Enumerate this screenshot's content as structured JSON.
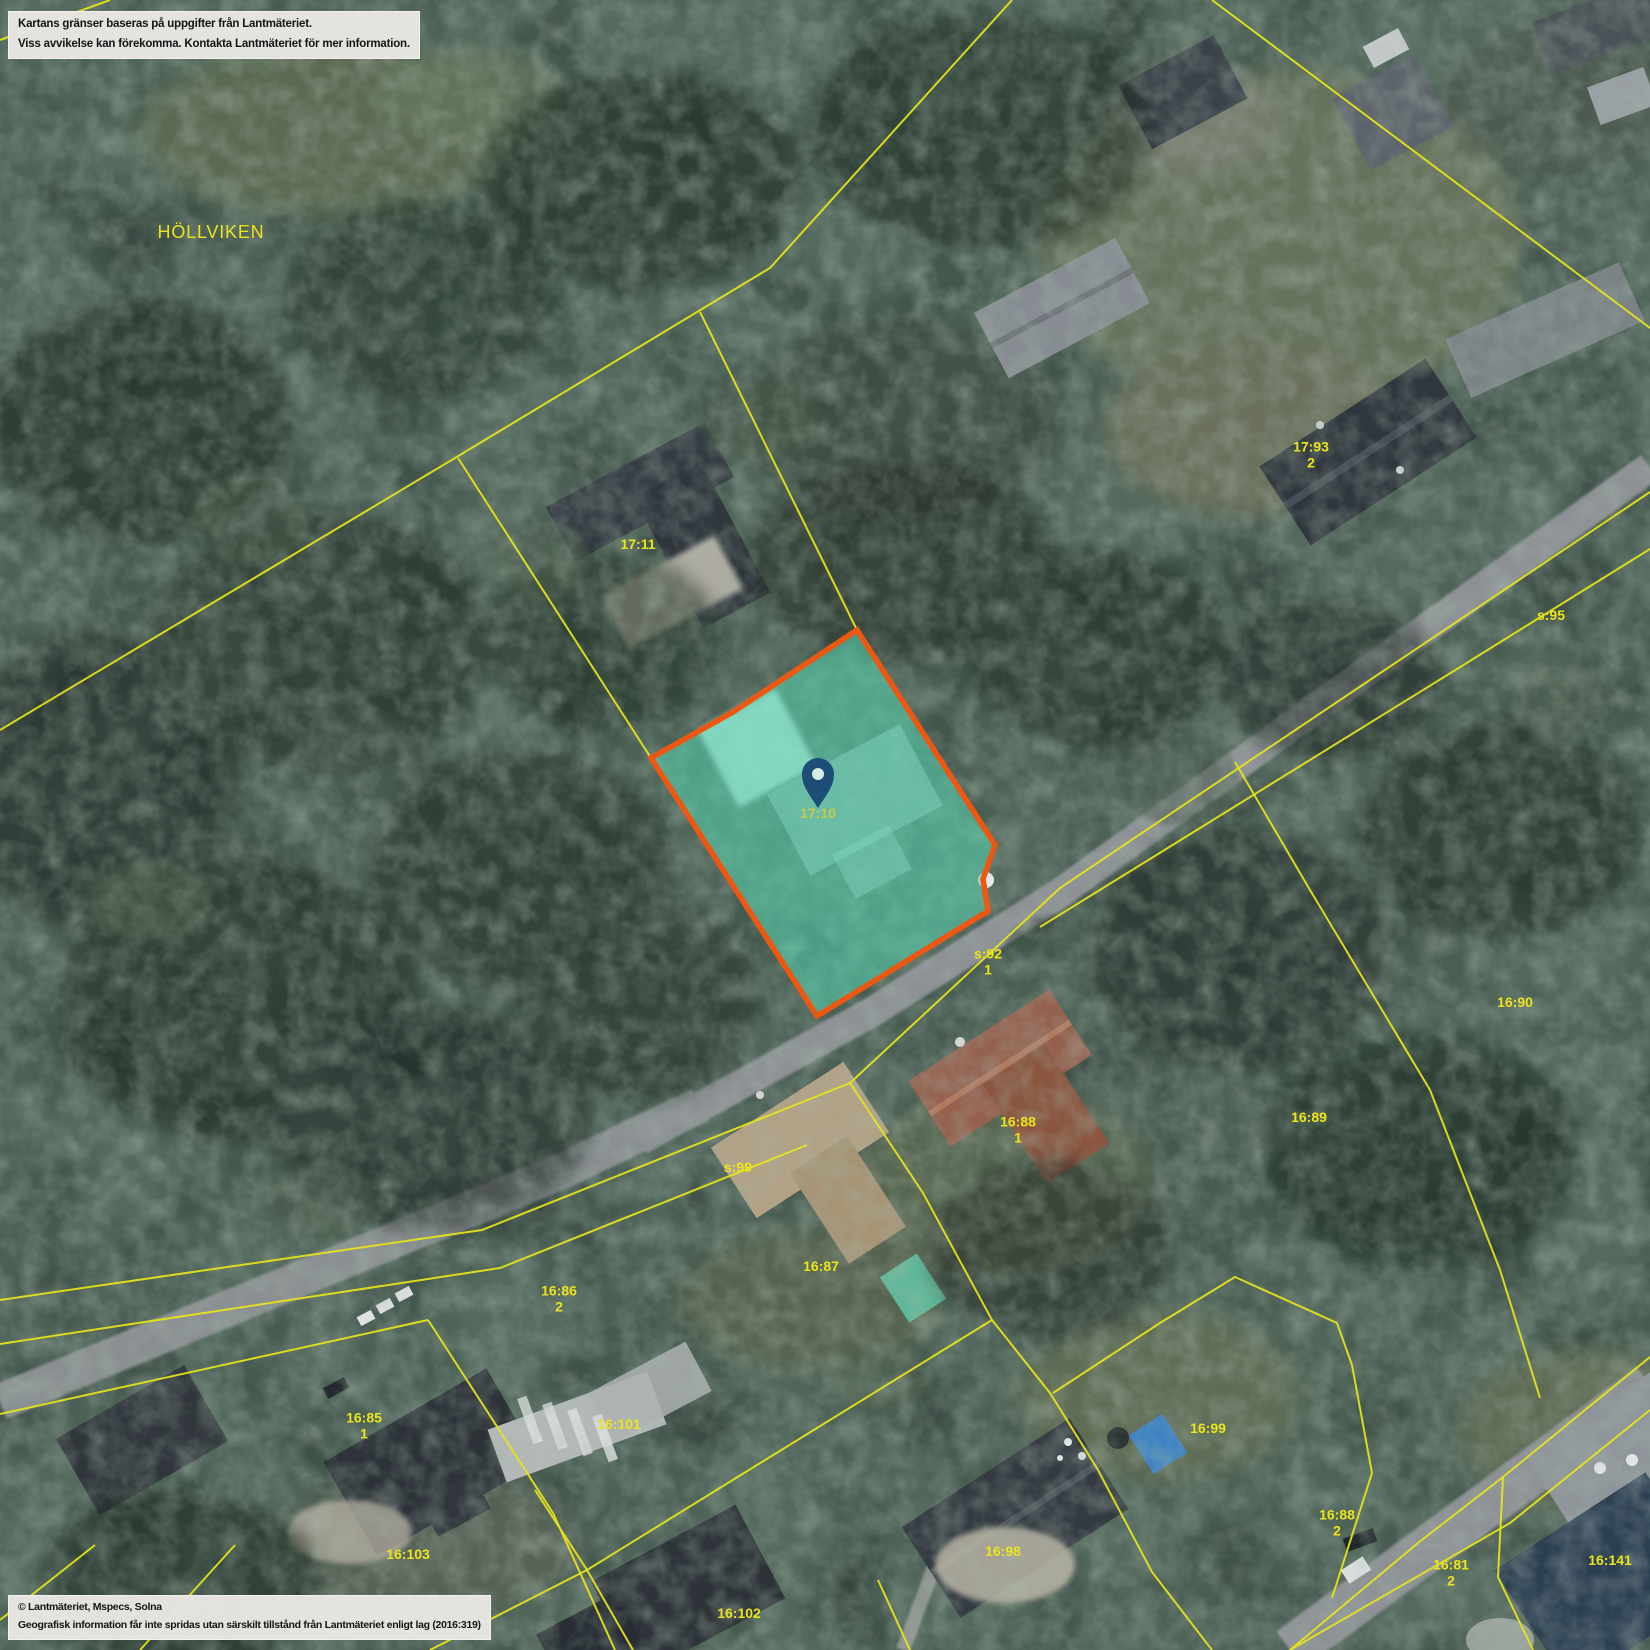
{
  "map": {
    "colors": {
      "boundary": "#e6e41c",
      "label": "#ece41c",
      "selected_label": "#d6cc3e",
      "parcel_fill": "rgba(86,214,178,0.55)",
      "parcel_stroke": "#ee5711",
      "pin": "#1d4e78",
      "pin_hole": "#d6ece4"
    },
    "selected_parcel": {
      "label": "17:10",
      "marker": "location-pin"
    },
    "labels": [
      {
        "kind": "place",
        "text": "HÖLLVIKEN",
        "x": 211,
        "y": 232
      },
      {
        "kind": "parcel",
        "text": "17:11",
        "x": 638,
        "y": 545
      },
      {
        "kind": "parcel",
        "text": "17:93",
        "sub": "2",
        "x": 1311,
        "y": 455
      },
      {
        "kind": "parcel",
        "text": "s:95",
        "x": 1551,
        "y": 616
      },
      {
        "kind": "selected",
        "text": "17:10",
        "x": 818,
        "y": 814
      },
      {
        "kind": "parcel",
        "text": "s:92",
        "sub": "1",
        "x": 988,
        "y": 962
      },
      {
        "kind": "parcel",
        "text": "16:90",
        "x": 1515,
        "y": 1003
      },
      {
        "kind": "parcel",
        "text": "16:89",
        "x": 1309,
        "y": 1118
      },
      {
        "kind": "parcel",
        "text": "16:88",
        "sub": "1",
        "x": 1018,
        "y": 1130
      },
      {
        "kind": "parcel",
        "text": "s:99",
        "x": 738,
        "y": 1168
      },
      {
        "kind": "parcel",
        "text": "16:87",
        "x": 821,
        "y": 1267
      },
      {
        "kind": "parcel",
        "text": "16:86",
        "sub": "2",
        "x": 559,
        "y": 1299
      },
      {
        "kind": "parcel",
        "text": "16:85",
        "sub": "1",
        "x": 364,
        "y": 1426
      },
      {
        "kind": "parcel",
        "text": "16:101",
        "x": 619,
        "y": 1425
      },
      {
        "kind": "parcel",
        "text": "16:103",
        "x": 408,
        "y": 1555
      },
      {
        "kind": "parcel",
        "text": "16:99",
        "x": 1208,
        "y": 1429
      },
      {
        "kind": "parcel",
        "text": "16:98",
        "x": 1003,
        "y": 1552
      },
      {
        "kind": "parcel",
        "text": "16:88",
        "sub": "2",
        "x": 1337,
        "y": 1523
      },
      {
        "kind": "parcel",
        "text": "16:81",
        "sub": "2",
        "x": 1451,
        "y": 1573
      },
      {
        "kind": "parcel",
        "text": "16:141",
        "x": 1610,
        "y": 1561
      },
      {
        "kind": "parcel",
        "text": "16:102",
        "x": 739,
        "y": 1614
      }
    ],
    "disclaimer": {
      "line1": "Kartans gränser baseras på uppgifter från Lantmäteriet.",
      "line2": "Viss avvikelse kan förekomma. Kontakta Lantmäteriet för mer information."
    },
    "attribution": {
      "line1": "© Lantmäteriet, Mspecs, Solna",
      "line2": "Geografisk information får inte spridas utan särskilt tillstånd från Lantmäteriet enligt lag (2016:319)"
    }
  }
}
